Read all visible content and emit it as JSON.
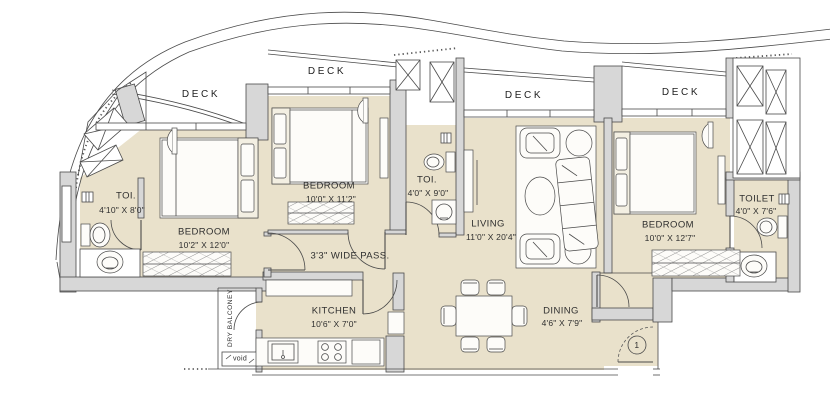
{
  "colors": {
    "floor": "#e9e1cb",
    "wall": "#d7d7d7",
    "line": "#4a4a4a",
    "furniture": "#fdfcf9"
  },
  "decks": [
    {
      "label": "DECK"
    },
    {
      "label": "DECK"
    },
    {
      "label": "DECK"
    },
    {
      "label": "DECK"
    }
  ],
  "rooms": {
    "toilet1": {
      "label": "TOI.",
      "dims": "4'10\" X 8'0\""
    },
    "bedroom1": {
      "label": "BEDROOM",
      "dims": "10'2\" X 12'0\""
    },
    "bedroom2": {
      "label": "BEDROOM",
      "dims": "10'0\" X 11'2\""
    },
    "toilet2": {
      "label": "TOI.",
      "dims": "4'0\" X 9'0\""
    },
    "living": {
      "label": "LIVING",
      "dims": "11'0\" X 20'4\""
    },
    "bedroom3": {
      "label": "BEDROOM",
      "dims": "10'0\" X 12'7\""
    },
    "toilet3": {
      "label": "TOILET",
      "dims": "4'0\" X 7'6\""
    },
    "kitchen": {
      "label": "KITCHEN",
      "dims": "10'6\" X 7'0\""
    },
    "dining": {
      "label": "DINING",
      "dims": "4'6\" X 7'9\""
    },
    "passage": {
      "label": "3'3\" WIDE PASS."
    },
    "dry_balcony": {
      "label": "DRY BALCONEY"
    },
    "void": {
      "label": "void"
    }
  },
  "entry": {
    "door_number": "1"
  }
}
